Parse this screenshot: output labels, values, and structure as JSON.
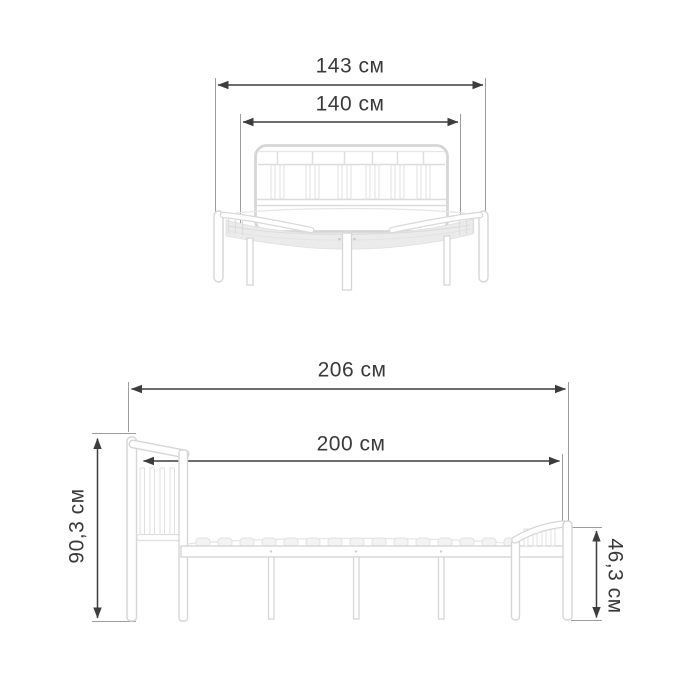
{
  "diagram": {
    "type": "product-dimension-drawing",
    "subject": "white metal bed frame, two projections",
    "unit_label": "см",
    "colors": {
      "background": "#ffffff",
      "dimension_line": "#3d3d3d",
      "extension_line": "#9d9d9d",
      "label_text": "#3a3a3a",
      "bed_outline": "#d6d6d6",
      "bed_fill": "#ffffff",
      "deck_fill": "#ebebeb"
    },
    "front_view": {
      "name": "front view (headboard side)",
      "dimensions": [
        {
          "id": "outer-width",
          "label": "143 см",
          "orientation": "horizontal"
        },
        {
          "id": "mattress-width",
          "label": "140 см",
          "orientation": "horizontal"
        }
      ]
    },
    "side_view": {
      "name": "side view",
      "dimensions": [
        {
          "id": "outer-length",
          "label": "206 см",
          "orientation": "horizontal"
        },
        {
          "id": "mattress-length",
          "label": "200 см",
          "orientation": "horizontal"
        },
        {
          "id": "headboard-height",
          "label": "90,3 см",
          "orientation": "vertical-left"
        },
        {
          "id": "footboard-height",
          "label": "46,3 см",
          "orientation": "vertical-right"
        }
      ]
    }
  }
}
